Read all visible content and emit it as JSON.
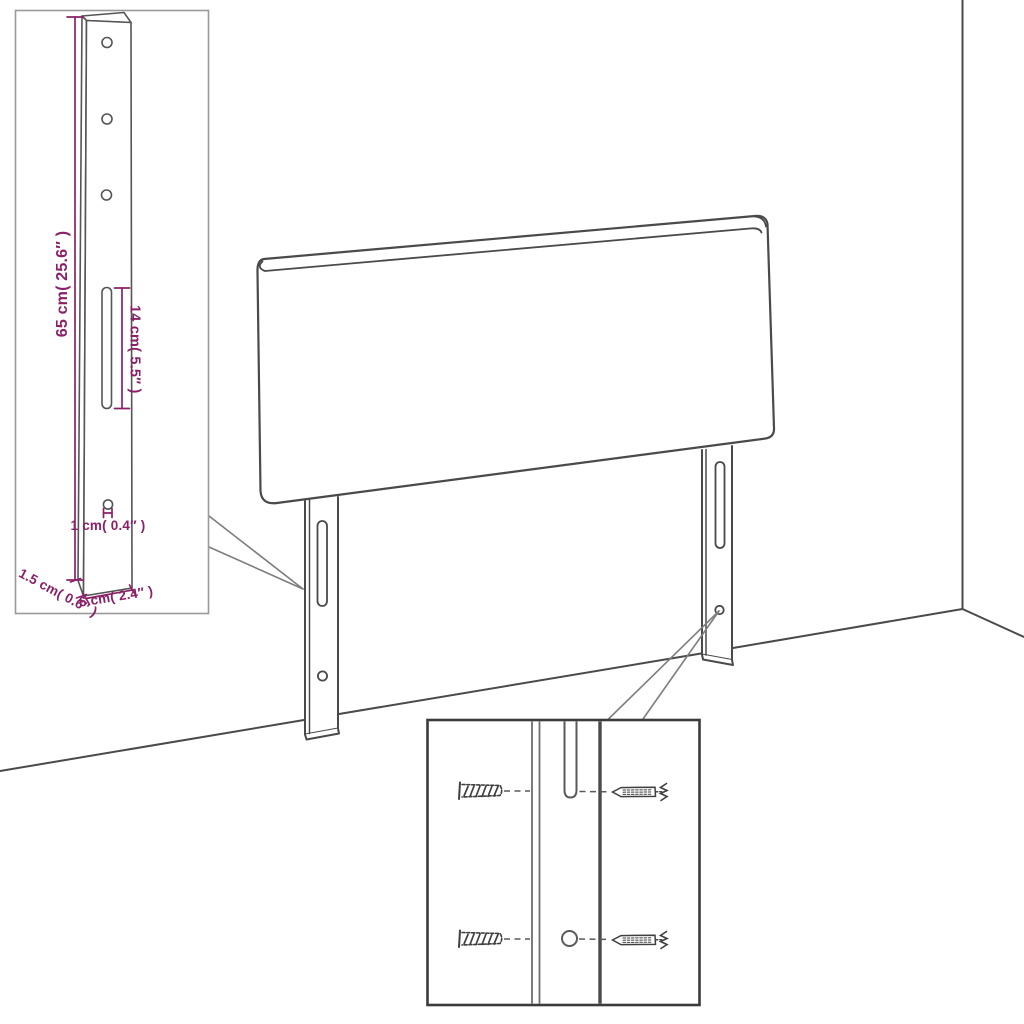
{
  "diagram": {
    "type": "product-dimension-diagram",
    "subject": "upholstered headboard with two adjustable mounting legs shown against a room corner",
    "colors": {
      "line_art": "#4a4a4a",
      "dimension_text": "#8A2168",
      "inset_border_light": "#9a9a9a",
      "inset_border_dark": "#3b3b3b",
      "background": "#ffffff"
    },
    "inset_bracket": {
      "description": "enlarged side view of mounting leg",
      "height": "65 cm( 25.6″ )",
      "slot_length": "14 cm( 5.5″ )",
      "hole_diameter": "1 cm( 0.4″ )",
      "thickness": "1.5 cm( 0.6″ )",
      "width": "6 cm( 2.4″ )"
    },
    "inset_fixings": {
      "description": "enlarged view of leg slot and hole with wall plugs and screws",
      "items": [
        "wall-plug",
        "screw",
        "keyhole-slot",
        "screw-hole"
      ]
    }
  }
}
